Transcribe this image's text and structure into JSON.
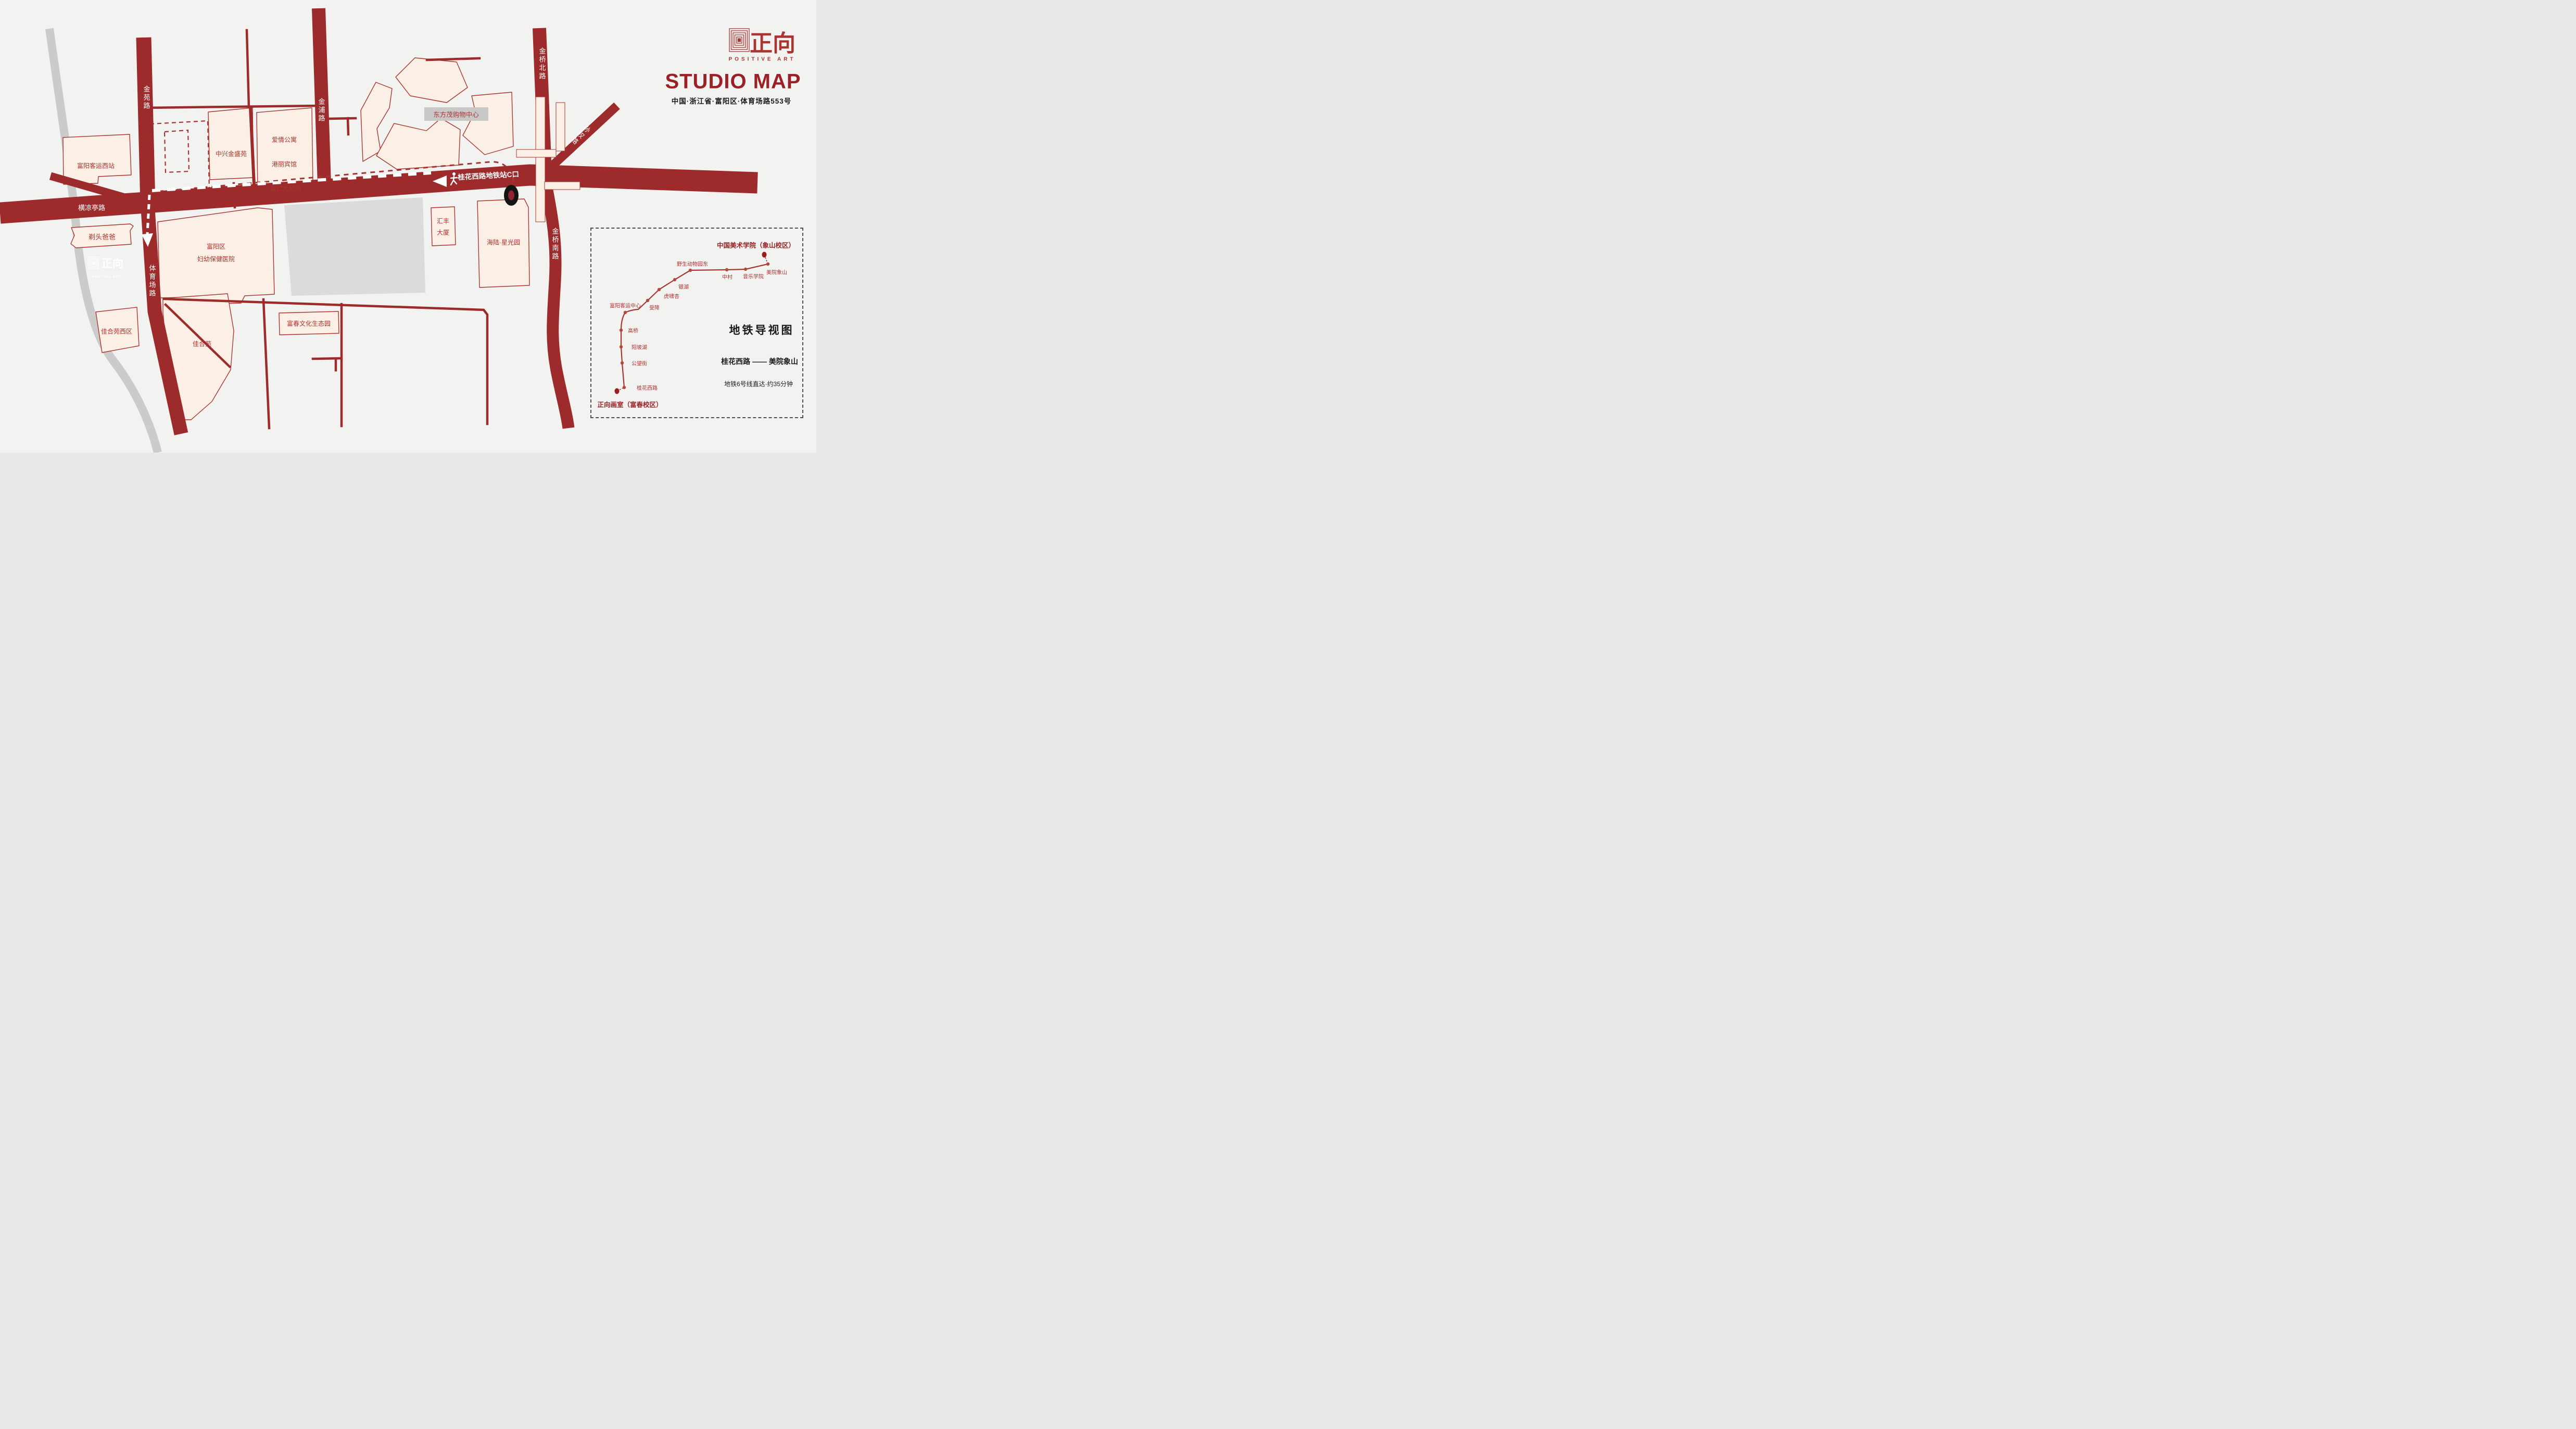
{
  "header": {
    "brand_cn": "正向",
    "brand_en": "POSITIVE ART",
    "title": "STUDIO MAP",
    "address": "中国·浙江省·富阳区·体育场路553号"
  },
  "map": {
    "roads": {
      "jinyuan": "金苑路",
      "jinpu": "金浦路",
      "hengliangting": "横凉亭路",
      "tiyuchang": "体育场路",
      "jinqiao_north": "金桥北路",
      "sunquan": "孙权路",
      "jinqiao_south": "金桥南路"
    },
    "station_exit": "桂花西路地铁站C口",
    "buildings": {
      "west_bus_station": "富阳客运西站",
      "zhongxing": "中兴金盛苑",
      "apartment": "爱情公寓",
      "hotel": "港丽宾馆",
      "pharmacy": "富仁大药房",
      "mall": "东方茂购物中心",
      "hsbc_l1": "汇丰",
      "hsbc_l2": "大厦",
      "hailu": "海陆·星光园",
      "hospital_l1": "富阳区",
      "hospital_l2": "妇幼保健医院",
      "barber": "剃头爸爸",
      "jiahe_west": "佳合苑西区",
      "jiahe": "佳合苑",
      "eco_park": "富春文化生态园"
    },
    "studio": {
      "brand_cn": "正向",
      "brand_en": "POSITIVE ART"
    }
  },
  "metro_panel": {
    "destination": "中国美术学院（象山校区）",
    "origin": "正向画室（富春校区）",
    "heading": "地铁导视图",
    "route": "桂花西路 —— 美院象山",
    "note": "地铁6号线直达·约35分钟",
    "stations": [
      "桂花西路",
      "公望街",
      "阳坡湖",
      "高桥",
      "富阳客运中心",
      "受降",
      "虎啸杏",
      "银湖",
      "野生动物园东",
      "中村",
      "音乐学院",
      "美院象山"
    ]
  }
}
